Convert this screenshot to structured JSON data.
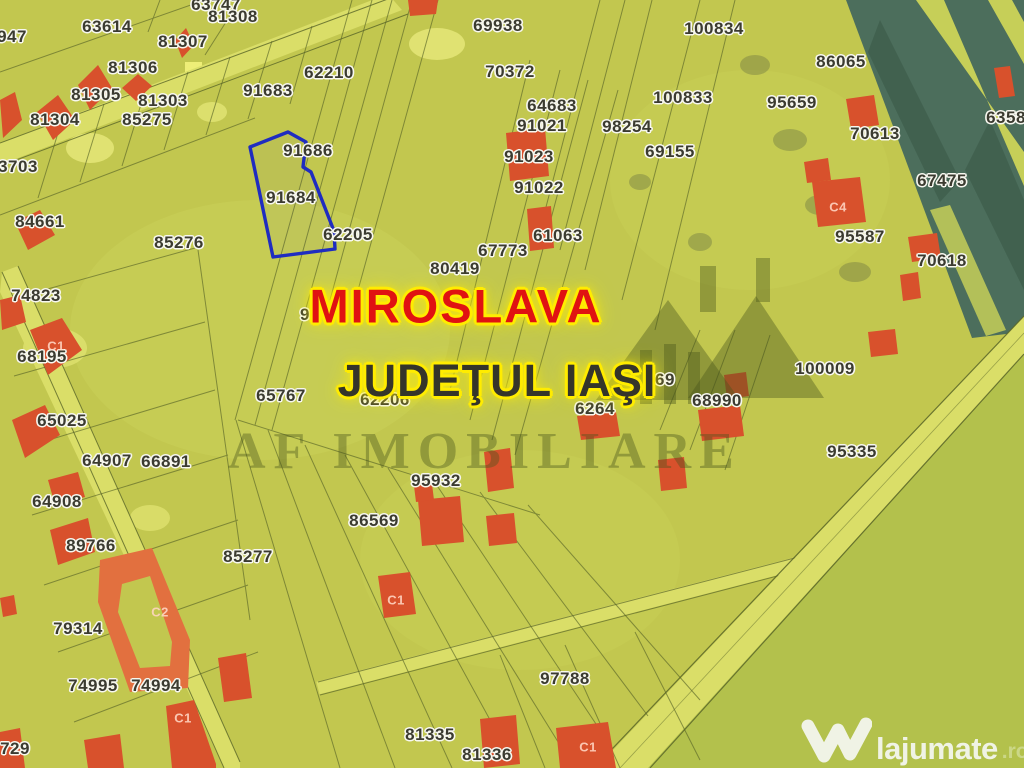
{
  "map": {
    "region": "MIROSLAVA",
    "county": "JUDEŢUL IAŞI",
    "highlighted_parcel": {
      "id": "91684"
    },
    "parcel_labels": [
      {
        "id": "63747",
        "x": 216,
        "y": 5
      },
      {
        "id": "81308",
        "x": 233,
        "y": 17
      },
      {
        "id": "63614",
        "x": 107,
        "y": 27
      },
      {
        "id": "947",
        "x": 12,
        "y": 37
      },
      {
        "id": "81307",
        "x": 183,
        "y": 42
      },
      {
        "id": "69938",
        "x": 498,
        "y": 26
      },
      {
        "id": "100834",
        "x": 714,
        "y": 29
      },
      {
        "id": "86065",
        "x": 841,
        "y": 62
      },
      {
        "id": "81306",
        "x": 133,
        "y": 68
      },
      {
        "id": "62210",
        "x": 329,
        "y": 73
      },
      {
        "id": "70372",
        "x": 510,
        "y": 72
      },
      {
        "id": "91683",
        "x": 268,
        "y": 91
      },
      {
        "id": "81305",
        "x": 96,
        "y": 95
      },
      {
        "id": "100833",
        "x": 683,
        "y": 98
      },
      {
        "id": "81303",
        "x": 163,
        "y": 101
      },
      {
        "id": "95659",
        "x": 792,
        "y": 103
      },
      {
        "id": "64683",
        "x": 552,
        "y": 106
      },
      {
        "id": "6358",
        "x": 1006,
        "y": 118
      },
      {
        "id": "85275",
        "x": 147,
        "y": 120
      },
      {
        "id": "81304",
        "x": 55,
        "y": 120
      },
      {
        "id": "91021",
        "x": 542,
        "y": 126
      },
      {
        "id": "98254",
        "x": 627,
        "y": 127
      },
      {
        "id": "70613",
        "x": 875,
        "y": 134
      },
      {
        "id": "69155",
        "x": 670,
        "y": 152
      },
      {
        "id": "91686",
        "x": 308,
        "y": 151
      },
      {
        "id": "91023",
        "x": 529,
        "y": 157
      },
      {
        "id": "3703",
        "x": 18,
        "y": 167
      },
      {
        "id": "67475",
        "x": 942,
        "y": 181
      },
      {
        "id": "91022",
        "x": 539,
        "y": 188
      },
      {
        "id": "91684",
        "x": 291,
        "y": 198
      },
      {
        "id": "84661",
        "x": 40,
        "y": 222
      },
      {
        "id": "62205",
        "x": 348,
        "y": 235
      },
      {
        "id": "61063",
        "x": 558,
        "y": 236
      },
      {
        "id": "95587",
        "x": 860,
        "y": 237
      },
      {
        "id": "85276",
        "x": 179,
        "y": 243
      },
      {
        "id": "67773",
        "x": 503,
        "y": 251
      },
      {
        "id": "70618",
        "x": 942,
        "y": 261
      },
      {
        "id": "80419",
        "x": 455,
        "y": 269
      },
      {
        "id": "74823",
        "x": 36,
        "y": 296
      },
      {
        "id": "91",
        "x": 310,
        "y": 315
      },
      {
        "id": "68195",
        "x": 42,
        "y": 357
      },
      {
        "id": "100009",
        "x": 825,
        "y": 369
      },
      {
        "id": "69",
        "x": 665,
        "y": 380
      },
      {
        "id": "65767",
        "x": 281,
        "y": 396
      },
      {
        "id": "62206",
        "x": 385,
        "y": 400
      },
      {
        "id": "68990",
        "x": 717,
        "y": 401
      },
      {
        "id": "6264",
        "x": 595,
        "y": 409
      },
      {
        "id": "65025",
        "x": 62,
        "y": 421
      },
      {
        "id": "95335",
        "x": 852,
        "y": 452
      },
      {
        "id": "64907",
        "x": 107,
        "y": 461
      },
      {
        "id": "66891",
        "x": 166,
        "y": 462
      },
      {
        "id": "95932",
        "x": 436,
        "y": 481
      },
      {
        "id": "64908",
        "x": 57,
        "y": 502
      },
      {
        "id": "86569",
        "x": 374,
        "y": 521
      },
      {
        "id": "89766",
        "x": 91,
        "y": 546
      },
      {
        "id": "85277",
        "x": 248,
        "y": 557
      },
      {
        "id": "79314",
        "x": 78,
        "y": 629
      },
      {
        "id": "97788",
        "x": 565,
        "y": 679
      },
      {
        "id": "74995",
        "x": 93,
        "y": 686
      },
      {
        "id": "74994",
        "x": 156,
        "y": 686
      },
      {
        "id": "81335",
        "x": 430,
        "y": 735
      },
      {
        "id": "729",
        "x": 15,
        "y": 749
      },
      {
        "id": "81336",
        "x": 487,
        "y": 755
      }
    ],
    "building_labels": [
      {
        "id": "C1",
        "x": 56,
        "y": 346
      },
      {
        "id": "C4",
        "x": 838,
        "y": 207
      },
      {
        "id": "C2",
        "x": 160,
        "y": 612
      },
      {
        "id": "C1",
        "x": 396,
        "y": 600
      },
      {
        "id": "C1",
        "x": 183,
        "y": 718
      },
      {
        "id": "C1",
        "x": 588,
        "y": 747
      }
    ]
  },
  "watermark": {
    "brand": "AF IMOBILIARE"
  },
  "logo": {
    "name": "lajumate",
    "tld": ".ro"
  },
  "colors": {
    "map_base": "#c2c74f",
    "field_light": "#cdd35a",
    "field_dark": "#b3c14c",
    "pale_patch": "#e7e97a",
    "forest_dark": "#4c6e5c",
    "forest_deep": "#41614f",
    "forest_light_strip": "#c6cf58",
    "road_fill": "#dade68",
    "line_color": "#5a6628",
    "building_red": "#d8512c",
    "building_orange": "#e2703f",
    "highlight_outline": "#1f2cc0",
    "label_text": "#3b3b30",
    "label_halo": "#f7f7ef",
    "watermark_yellow": "#ffec00",
    "city_red": "#e01212",
    "county_dark": "#35352a",
    "brand_translucent": "rgba(72,86,28,0.40)",
    "logo_white": "#f4f6ee",
    "logo_accent": "#cdd98b"
  }
}
